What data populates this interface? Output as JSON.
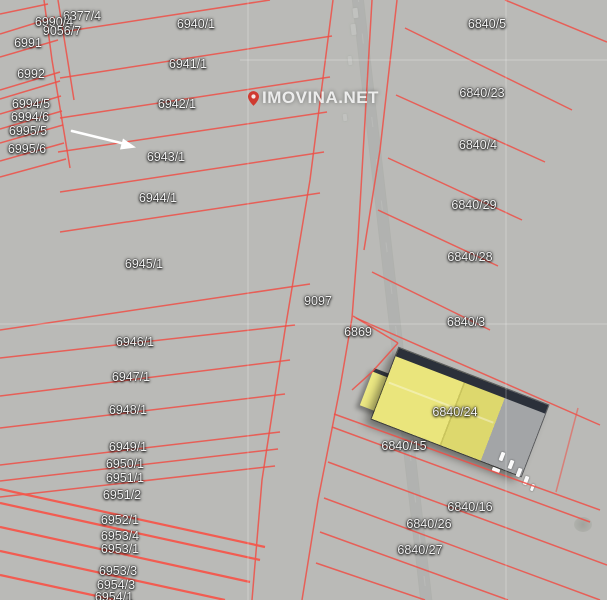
{
  "map": {
    "watermark": {
      "text": "IMOVINA.NET"
    },
    "annotation": {
      "arrow_icon": "white arrow pointing at parcel 6943/1"
    },
    "colors": {
      "parcel_line": "#ee4f46",
      "parcel_line_bright": "#f4564b",
      "label_text": "#f4f4f4",
      "watermark_text": "rgba(255,255,255,0.82)",
      "watermark_pin": "#cf3a30",
      "building_roof_yellow": "#eae57c",
      "road_asphalt": "#87898b",
      "grid_line": "rgba(255,255,255,0.3)"
    },
    "parcels": [
      {
        "label": "6377/4",
        "x": 82,
        "y": 16
      },
      {
        "label": "6990/4",
        "x": 54,
        "y": 22
      },
      {
        "label": "9056/7",
        "x": 62,
        "y": 31
      },
      {
        "label": "6991",
        "x": 28,
        "y": 43
      },
      {
        "label": "6992",
        "x": 31,
        "y": 74
      },
      {
        "label": "6994/5",
        "x": 31,
        "y": 104
      },
      {
        "label": "6994/6",
        "x": 30,
        "y": 117
      },
      {
        "label": "6995/5",
        "x": 28,
        "y": 131
      },
      {
        "label": "6995/6",
        "x": 27,
        "y": 149
      },
      {
        "label": "6940/1",
        "x": 196,
        "y": 24
      },
      {
        "label": "6941/1",
        "x": 188,
        "y": 64
      },
      {
        "label": "6942/1",
        "x": 177,
        "y": 104
      },
      {
        "label": "6943/1",
        "x": 166,
        "y": 157
      },
      {
        "label": "6944/1",
        "x": 158,
        "y": 198
      },
      {
        "label": "6945/1",
        "x": 144,
        "y": 264
      },
      {
        "label": "6946/1",
        "x": 135,
        "y": 342
      },
      {
        "label": "6947/1",
        "x": 131,
        "y": 377
      },
      {
        "label": "6948/1",
        "x": 128,
        "y": 410
      },
      {
        "label": "6949/1",
        "x": 128,
        "y": 447
      },
      {
        "label": "6950/1",
        "x": 125,
        "y": 464
      },
      {
        "label": "6951/1",
        "x": 125,
        "y": 478
      },
      {
        "label": "6951/2",
        "x": 122,
        "y": 495
      },
      {
        "label": "6952/1",
        "x": 120,
        "y": 520
      },
      {
        "label": "6953/4",
        "x": 120,
        "y": 536
      },
      {
        "label": "6953/1",
        "x": 120,
        "y": 549
      },
      {
        "label": "6953/3",
        "x": 118,
        "y": 571
      },
      {
        "label": "6954/3",
        "x": 116,
        "y": 585
      },
      {
        "label": "6954/1",
        "x": 114,
        "y": 597
      },
      {
        "label": "9097",
        "x": 318,
        "y": 301
      },
      {
        "label": "6869",
        "x": 358,
        "y": 332
      },
      {
        "label": "6840/5",
        "x": 487,
        "y": 24
      },
      {
        "label": "6840/23",
        "x": 482,
        "y": 93
      },
      {
        "label": "6840/4",
        "x": 478,
        "y": 145
      },
      {
        "label": "6840/29",
        "x": 474,
        "y": 205
      },
      {
        "label": "6840/28",
        "x": 470,
        "y": 257
      },
      {
        "label": "6840/3",
        "x": 466,
        "y": 322
      },
      {
        "label": "6840/24",
        "x": 455,
        "y": 412
      },
      {
        "label": "6840/15",
        "x": 404,
        "y": 446
      },
      {
        "label": "6840/16",
        "x": 470,
        "y": 507
      },
      {
        "label": "6840/26",
        "x": 429,
        "y": 524
      },
      {
        "label": "6840/27",
        "x": 420,
        "y": 550
      }
    ]
  }
}
